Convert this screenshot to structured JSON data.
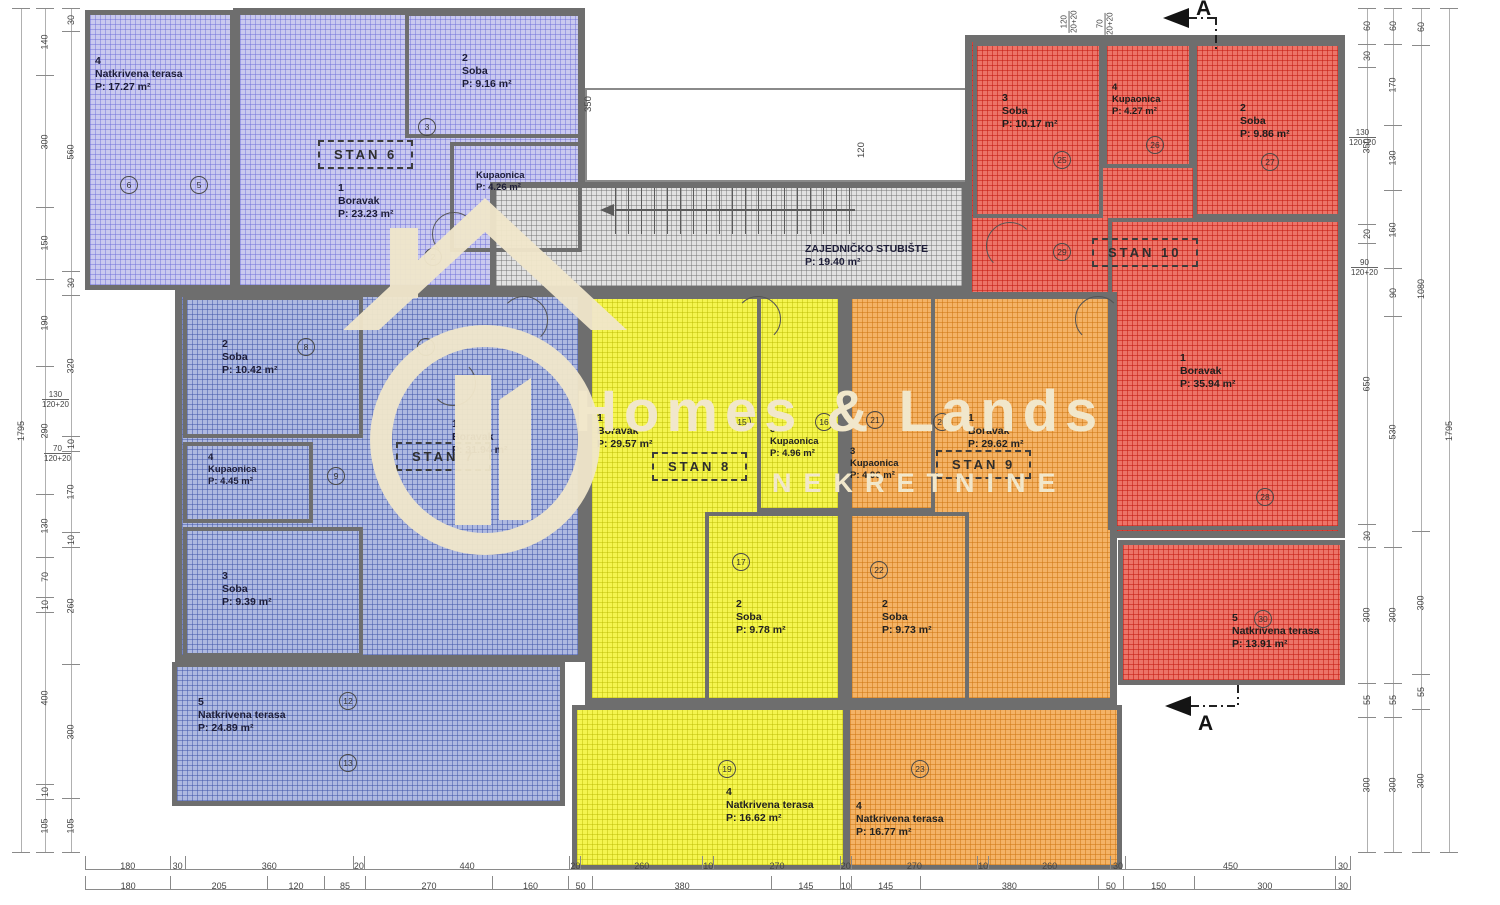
{
  "watermark": {
    "title": "Homes & Lands",
    "subtitle": "NEKRETNINE"
  },
  "section": {
    "label": "A"
  },
  "staircase": {
    "name": "ZAJEDNIČKO STUBIŠTE",
    "area": "P: 19.40 m²"
  },
  "units": {
    "stan6": {
      "label": "STAN 6",
      "color": "#c9c9ef",
      "rooms": {
        "terasa": {
          "num": "4",
          "name": "Natkrivena terasa",
          "area": "P: 17.27 m²"
        },
        "boravak": {
          "num": "1",
          "name": "Boravak",
          "area": "P: 23.23 m²"
        },
        "soba": {
          "num": "2",
          "name": "Soba",
          "area": "P: 9.16 m²"
        },
        "kupaonica": {
          "num": "3",
          "name": "Kupaonica",
          "area": "P: 4.26 m²"
        }
      }
    },
    "stan7": {
      "label": "STAN 7",
      "color": "#aeb9e0",
      "rooms": {
        "boravak": {
          "num": "1",
          "name": "Boravak",
          "area": "P: 31.94 m²"
        },
        "soba2": {
          "num": "2",
          "name": "Soba",
          "area": "P: 10.42 m²"
        },
        "soba3": {
          "num": "3",
          "name": "Soba",
          "area": "P: 9.39 m²"
        },
        "kupaonica": {
          "num": "4",
          "name": "Kupaonica",
          "area": "P: 4.45 m²"
        },
        "terasa": {
          "num": "5",
          "name": "Natkrivena terasa",
          "area": "P: 24.89 m²"
        }
      }
    },
    "stan8": {
      "label": "STAN 8",
      "color": "#f5f54f",
      "rooms": {
        "boravak": {
          "num": "1",
          "name": "Boravak",
          "area": "P: 29.57 m²"
        },
        "soba": {
          "num": "2",
          "name": "Soba",
          "area": "P: 9.78 m²"
        },
        "kupaonica": {
          "num": "3",
          "name": "Kupaonica",
          "area": "P: 4.96 m²"
        },
        "terasa": {
          "num": "4",
          "name": "Natkrivena terasa",
          "area": "P: 16.62 m²"
        }
      }
    },
    "stan9": {
      "label": "STAN 9",
      "color": "#f4b366",
      "rooms": {
        "boravak": {
          "num": "1",
          "name": "Boravak",
          "area": "P: 29.62 m²"
        },
        "soba": {
          "num": "2",
          "name": "Soba",
          "area": "P: 9.73 m²"
        },
        "kupaonica": {
          "num": "3",
          "name": "Kupaonica",
          "area": "P: 4.96 m²"
        },
        "terasa": {
          "num": "4",
          "name": "Natkrivena terasa",
          "area": "P: 16.77 m²"
        }
      }
    },
    "stan10": {
      "label": "STAN 10",
      "color": "#ec7468",
      "rooms": {
        "boravak": {
          "num": "1",
          "name": "Boravak",
          "area": "P: 35.94 m²"
        },
        "soba2": {
          "num": "2",
          "name": "Soba",
          "area": "P: 9.86 m²"
        },
        "soba3": {
          "num": "3",
          "name": "Soba",
          "area": "P: 10.17 m²"
        },
        "kupaonica": {
          "num": "4",
          "name": "Kupaonica",
          "area": "P: 4.27 m²"
        },
        "terasa": {
          "num": "5",
          "name": "Natkrivena terasa",
          "area": "P: 13.91 m²"
        }
      }
    }
  },
  "dimensions": {
    "bottom_row_outer": [
      180,
      30,
      360,
      20,
      440,
      20,
      260,
      10,
      270,
      20,
      270,
      10,
      260,
      30,
      450,
      30
    ],
    "bottom_row_inner": [
      180,
      205,
      120,
      85,
      270,
      160,
      50,
      380,
      145,
      10,
      145,
      380,
      50,
      150,
      300,
      30
    ],
    "left_outer": [
      1795
    ],
    "left_mid": [
      140,
      300,
      150,
      190,
      290,
      130,
      70,
      10,
      400,
      10,
      105
    ],
    "left_inner": [
      30,
      560,
      30,
      320,
      10,
      170,
      10,
      260,
      300,
      105
    ],
    "right_inner": [
      60,
      30,
      350,
      20,
      650,
      30,
      300,
      55,
      300
    ],
    "right_mid": [
      60,
      170,
      130,
      160,
      90,
      530,
      300,
      55,
      300
    ],
    "right_outer": [
      60,
      1080,
      300,
      55,
      300
    ],
    "right_total": [
      1795
    ],
    "top_rotated": [
      {
        "v": "350",
        "x": 583,
        "y": 112
      },
      {
        "v": "120",
        "x": 856,
        "y": 158
      }
    ],
    "window_labels": [
      {
        "top": "130",
        "bottom": "120+20",
        "x": 42,
        "y": 390,
        "rot": false
      },
      {
        "top": "70",
        "bottom": "120+20",
        "x": 44,
        "y": 444,
        "rot": false
      },
      {
        "top": "130",
        "bottom": "120+20",
        "x": 1349,
        "y": 128,
        "rot": false
      },
      {
        "top": "90",
        "bottom": "120+20",
        "x": 1351,
        "y": 258,
        "rot": false
      },
      {
        "top": "120",
        "bottom": "20+20",
        "x": 1058,
        "y": 12,
        "rot": true
      },
      {
        "top": "70",
        "bottom": "20+20",
        "x": 1094,
        "y": 14,
        "rot": true
      }
    ]
  },
  "badges": [
    {
      "n": "6",
      "x": 120,
      "y": 176
    },
    {
      "n": "5",
      "x": 190,
      "y": 176
    },
    {
      "n": "3",
      "x": 418,
      "y": 118
    },
    {
      "n": "2",
      "x": 424,
      "y": 248
    },
    {
      "n": "8",
      "x": 297,
      "y": 338
    },
    {
      "n": "7",
      "x": 417,
      "y": 338
    },
    {
      "n": "9",
      "x": 327,
      "y": 467
    },
    {
      "n": "12",
      "x": 339,
      "y": 692
    },
    {
      "n": "13",
      "x": 339,
      "y": 754
    },
    {
      "n": "15",
      "x": 733,
      "y": 413
    },
    {
      "n": "16",
      "x": 815,
      "y": 413
    },
    {
      "n": "17",
      "x": 732,
      "y": 553
    },
    {
      "n": "19",
      "x": 718,
      "y": 760
    },
    {
      "n": "21",
      "x": 866,
      "y": 411
    },
    {
      "n": "20",
      "x": 933,
      "y": 413
    },
    {
      "n": "22",
      "x": 870,
      "y": 561
    },
    {
      "n": "23",
      "x": 911,
      "y": 760
    },
    {
      "n": "25",
      "x": 1053,
      "y": 151
    },
    {
      "n": "26",
      "x": 1146,
      "y": 136
    },
    {
      "n": "27",
      "x": 1261,
      "y": 153
    },
    {
      "n": "29",
      "x": 1053,
      "y": 243
    },
    {
      "n": "28",
      "x": 1256,
      "y": 488
    },
    {
      "n": "30",
      "x": 1254,
      "y": 610
    }
  ]
}
